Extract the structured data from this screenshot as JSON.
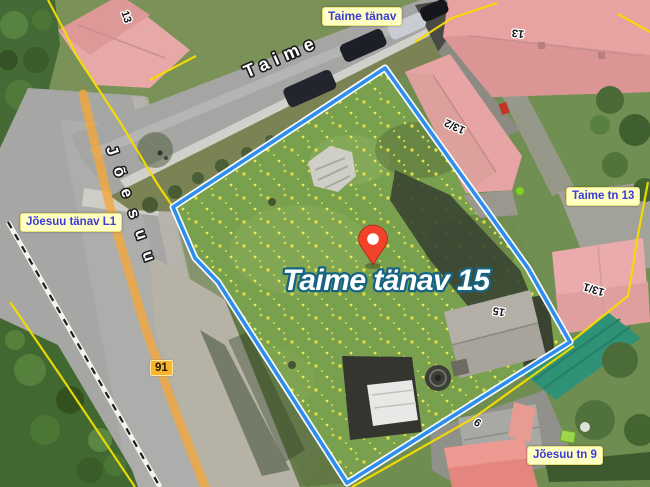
{
  "map": {
    "marker": {
      "title": "Taime tänav 15"
    },
    "street_sign": "Taime tänav",
    "streets": {
      "taime": "Taime",
      "joesuu": "Jõesuu"
    },
    "addresses": {
      "joesuu_l1": "Jõesuu tänav L1",
      "taime_tn_13": "Taime tn 13",
      "joesuu_tn_9": "Jõesuu tn 9"
    },
    "road_badge": "91",
    "parcel_numbers": {
      "p13_nw": "13",
      "p13_ne": "13",
      "p13_2": "13/2",
      "p13_1": "13/1",
      "p15": "15",
      "p9": "9"
    },
    "colors": {
      "selection_outline": "#2e8ef0",
      "cadastral_line": "#f6dc00",
      "marker_red": "#f2432a",
      "label_text_blue": "#3b3bd6",
      "label_bg": "#ffffc2"
    }
  }
}
